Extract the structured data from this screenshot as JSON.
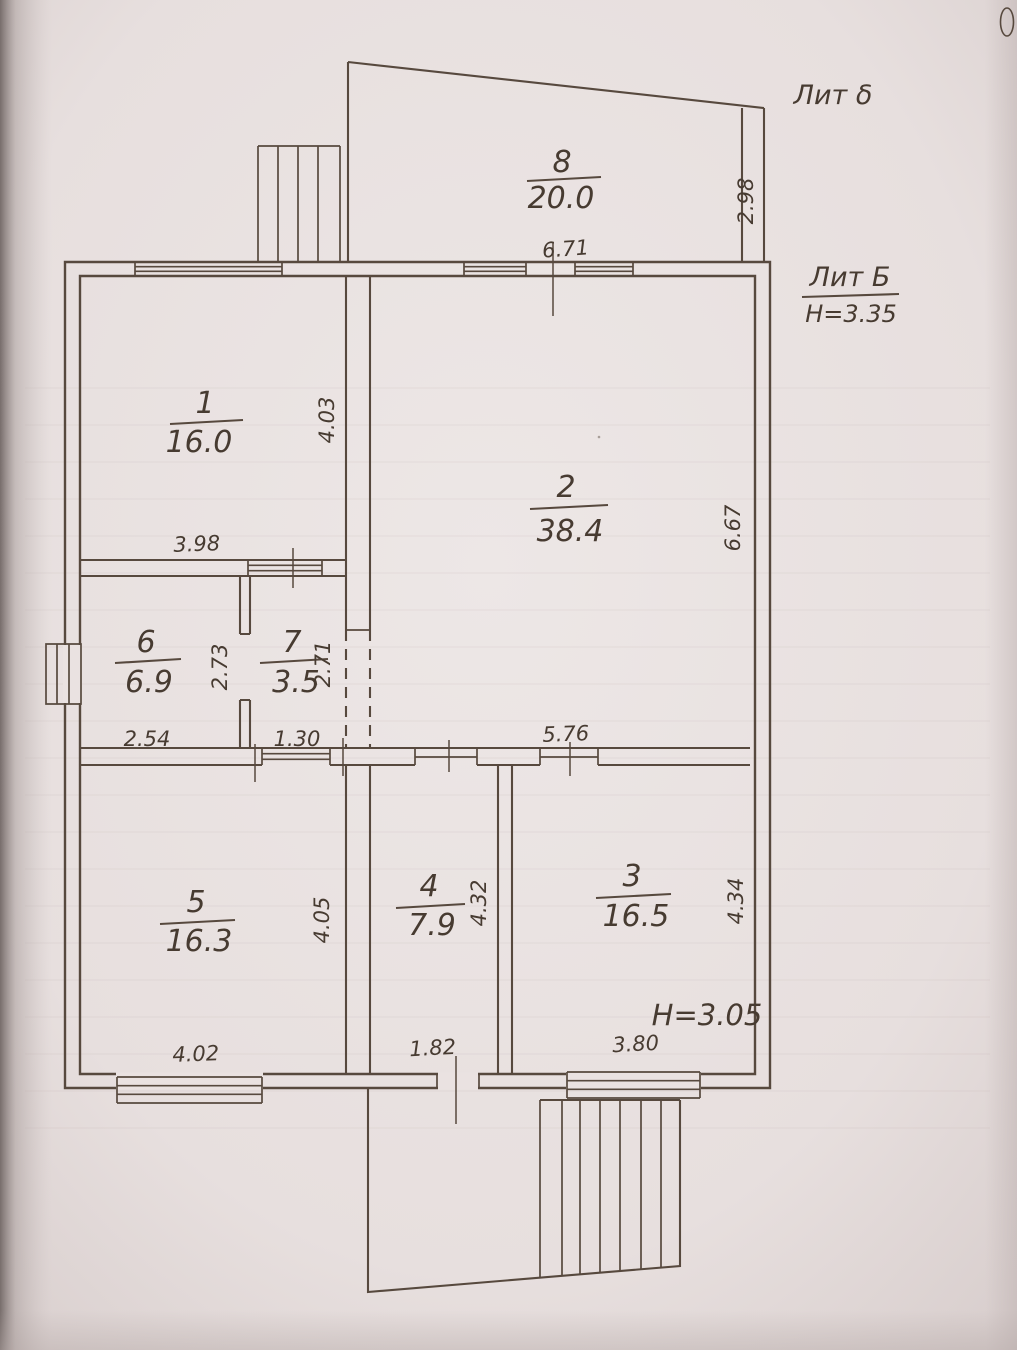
{
  "colors": {
    "ink": "#57493e",
    "paper": "#eae2e1"
  },
  "annotations": {
    "lit_small": "Лит δ",
    "lit_main": "Лит Б",
    "lit_main_height": "Н=3.35",
    "inner_height": "Н=3.05"
  },
  "rooms": [
    {
      "number": "8",
      "area": "20.0",
      "width_dim": "6.71",
      "height_dim": "2.98"
    },
    {
      "number": "1",
      "area": "16.0",
      "width_dim": "3.98",
      "height_dim": "4.03"
    },
    {
      "number": "2",
      "area": "38.4",
      "width_dim": "5.76",
      "height_dim": "6.67"
    },
    {
      "number": "6",
      "area": "6.9",
      "width_dim": "2.54",
      "height_dim": "2.73"
    },
    {
      "number": "7",
      "area": "3.5",
      "width_dim": "1.30",
      "height_dim": "2.71"
    },
    {
      "number": "5",
      "area": "16.3",
      "width_dim": "4.02",
      "height_dim": "4.05"
    },
    {
      "number": "4",
      "area": "7.9",
      "width_dim": "1.82",
      "height_dim": "4.32"
    },
    {
      "number": "3",
      "area": "16.5",
      "width_dim": "3.80",
      "height_dim": "4.34"
    }
  ]
}
